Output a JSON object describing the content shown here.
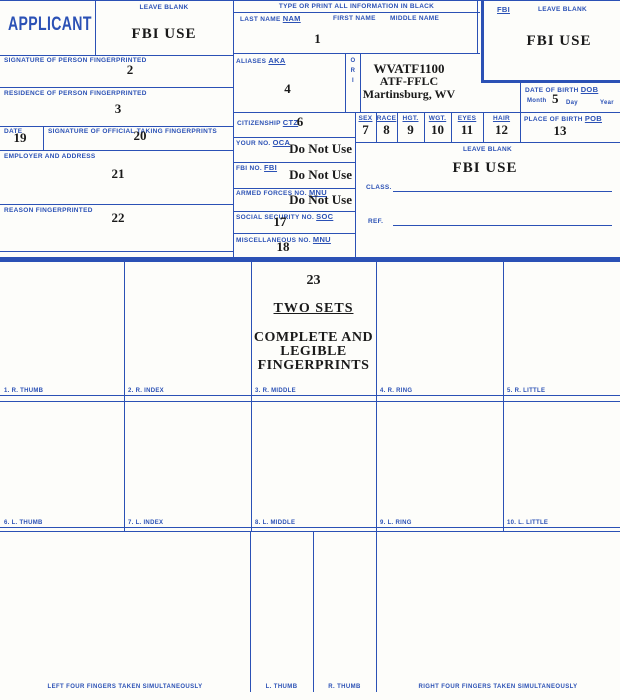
{
  "colors": {
    "accent_blue": "#2b51b5",
    "ink_black": "#1a1a1a"
  },
  "card": {
    "applicant": "APPLICANT",
    "type_header": "TYPE OR PRINT ALL INFORMATION IN BLACK"
  },
  "left": {
    "leave_blank": "LEAVE BLANK",
    "fbi_use": "FBI USE",
    "signature_label": "SIGNATURE OF PERSON FINGERPRINTED",
    "signature_value": "2",
    "residence_label": "RESIDENCE OF PERSON FINGERPRINTED",
    "residence_value": "3",
    "date_label": "DATE",
    "date_value": "19",
    "official_label": "SIGNATURE OF OFFICIAL TAKING FINGERPRINTS",
    "official_value": "20",
    "employer_label": "EMPLOYER AND ADDRESS",
    "employer_value": "21",
    "reason_label": "REASON FINGERPRINTED",
    "reason_value": "22"
  },
  "name": {
    "last_label": "LAST NAME",
    "last_code": "NAM",
    "first_label": "FIRST NAME",
    "middle_label": "MIDDLE NAME",
    "value": "1"
  },
  "aliases": {
    "label": "ALIASES",
    "code": "AKA",
    "value": "4"
  },
  "ori": {
    "letters": [
      "O",
      "R",
      "I"
    ],
    "line1": "WVATF1100",
    "line2": "ATF-FFLC",
    "line3": "Martinsburg, WV"
  },
  "citizenship": {
    "label": "CITIZENSHIP",
    "code": "CTZ",
    "value": "6"
  },
  "numbers": {
    "oca_label": "YOUR NO.",
    "oca_code": "OCA",
    "oca_value": "Do Not Use",
    "fbi_label": "FBI NO.",
    "fbi_code": "FBI",
    "fbi_value": "Do Not Use",
    "mnu_label": "ARMED FORCES NO.",
    "mnu_code": "MNU",
    "mnu_value": "Do Not Use",
    "soc_label": "SOCIAL SECURITY NO.",
    "soc_code": "SOC",
    "soc_value": "17",
    "misc_label": "MISCELLANEOUS NO.",
    "misc_code": "MNU",
    "misc_value": "18"
  },
  "fbi_box": {
    "code": "FBI",
    "leave_blank": "LEAVE BLANK",
    "fbi_use": "FBI USE"
  },
  "dob": {
    "label": "DATE OF BIRTH",
    "code": "DOB",
    "month": "Month",
    "day": "Day",
    "year": "Year",
    "value": "5"
  },
  "demographics": [
    {
      "label": "SEX",
      "value": "7"
    },
    {
      "label": "RACE",
      "value": "8"
    },
    {
      "label": "HGT.",
      "value": "9"
    },
    {
      "label": "WGT.",
      "value": "10"
    },
    {
      "label": "EYES",
      "value": "11"
    },
    {
      "label": "HAIR",
      "value": "12"
    }
  ],
  "pob": {
    "label": "PLACE OF BIRTH",
    "code": "POB",
    "value": "13"
  },
  "class_box": {
    "leave_blank": "LEAVE BLANK",
    "fbi_use": "FBI USE",
    "class_label": "CLASS.",
    "ref_label": "REF."
  },
  "prints": {
    "note_number": "23",
    "note_line1": "TWO SETS",
    "note_line2": "COMPLETE AND",
    "note_line3": "LEGIBLE",
    "note_line4": "FINGERPRINTS",
    "row1": [
      "1. R. THUMB",
      "2. R. INDEX",
      "3. R. MIDDLE",
      "4. R. RING",
      "5. R. LITTLE"
    ],
    "row2": [
      "6. L. THUMB",
      "7. L. INDEX",
      "8. L. MIDDLE",
      "9. L. RING",
      "10. L. LITTLE"
    ],
    "bottom": [
      "LEFT FOUR FINGERS TAKEN SIMULTANEOUSLY",
      "L. THUMB",
      "R. THUMB",
      "RIGHT FOUR FINGERS TAKEN SIMULTANEOUSLY"
    ]
  }
}
